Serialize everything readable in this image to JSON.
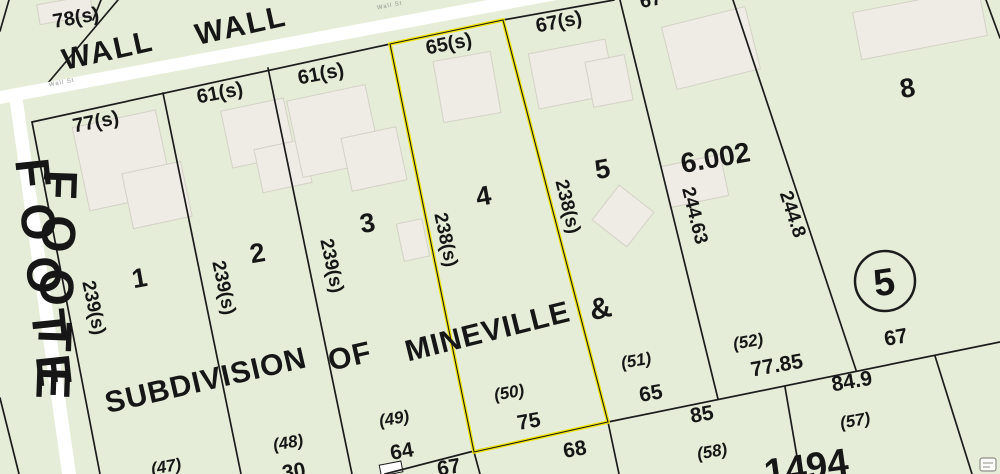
{
  "colors": {
    "background": "#e5ecd7",
    "road": "#ffffff",
    "parcel_line": "#1c1c1c",
    "highlight_yellow": "#f1e50a",
    "building_fill": "#eeece4",
    "label_black": "#161616",
    "road_label_gray": "#8f958f"
  },
  "streets": {
    "wall_1": "WALL",
    "wall_2": "WALL",
    "wall_st_1": "Wall St",
    "wall_st_2": "Wall St",
    "foote_1": "FOOTE",
    "foote_2": "FOOTE"
  },
  "lot_numbers": {
    "lot_1": "1",
    "lot_2": "2",
    "lot_3": "3",
    "lot_4": "4",
    "lot_5": "5",
    "lot_8": "8",
    "lot_6002": "6.002",
    "block_circle_5": "5"
  },
  "subdivision": {
    "word_1": "SUBDIVISION",
    "word_2": "OF",
    "word_3": "MINEVILLE",
    "word_4": "&"
  },
  "dimensions": {
    "d_78s": "78(s)",
    "d_77s": "77(s)",
    "d_61s_a": "61(s)",
    "d_61s_b": "61(s)",
    "d_65s": "65(s)",
    "d_67s": "67(s)",
    "d_67_top": "67",
    "d_239s_a": "239(s)",
    "d_239s_b": "239(s)",
    "d_239s_c": "239(s)",
    "d_238s_a": "238(s)",
    "d_238s_b": "238(s)",
    "d_244_63": "244.63",
    "d_244_8": "244.8",
    "d_64": "64",
    "d_67_sw": "67",
    "d_30": "30",
    "d_75": "75",
    "d_68": "68",
    "d_65": "65",
    "d_85": "85",
    "d_77_85": "77.85",
    "d_84_9": "84.9",
    "d_67_c5": "67"
  },
  "parcel_refs": {
    "p_47": "(47)",
    "p_48": "(48)",
    "p_49": "(49)",
    "p_50": "(50)",
    "p_51": "(51)",
    "p_52": "(52)",
    "p_57": "(57)",
    "p_58": "(58)",
    "p_1494": "1494"
  }
}
